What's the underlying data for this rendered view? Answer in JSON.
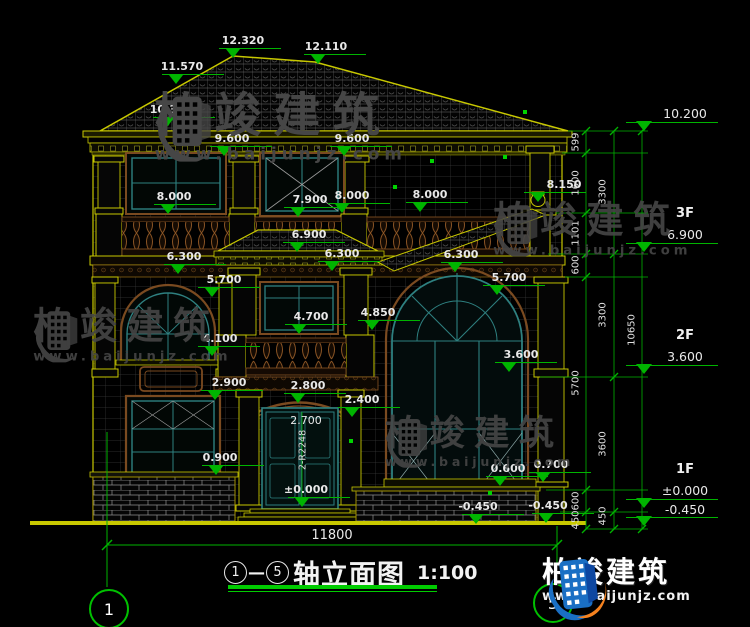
{
  "colors": {
    "bg": "#000000",
    "cad_yellow": "#c8c800",
    "cad_green": "#00b400",
    "text": "#e8e8e8",
    "window_teal": "#2e8080",
    "trim_brown": "#7a4a20",
    "logo_blue": "#1a6fc4",
    "logo_orange": "#f5821f"
  },
  "title_block": {
    "axis_from": "1",
    "axis_to": "5",
    "dash": "—",
    "title": "轴立面图",
    "scale": "1:100"
  },
  "axis_bubbles": {
    "left": "1",
    "right": "5"
  },
  "bottom_dim": "11800",
  "door_annotation": {
    "height": "2.700",
    "radius": "2-R2248"
  },
  "watermark": {
    "brand": "柏竣建筑",
    "url": "www.baijunjz.com"
  },
  "brand_logo": {
    "brand": "柏竣建筑",
    "url": "www.baijunjz.com"
  },
  "drawing": {
    "elevation_markers": [
      {
        "v": "12.320",
        "x": 233,
        "y": 58,
        "dx": 10
      },
      {
        "v": "12.110",
        "x": 318,
        "y": 64,
        "dx": 8
      },
      {
        "v": "11.570",
        "x": 176,
        "y": 84,
        "dx": 6
      },
      {
        "v": "10.350",
        "x": 167,
        "y": 127,
        "dx": 4
      },
      {
        "v": "9.600",
        "x": 224,
        "y": 156,
        "dx": 8
      },
      {
        "v": "9.600",
        "x": 344,
        "y": 156,
        "dx": 8
      },
      {
        "v": "8.000",
        "x": 168,
        "y": 214,
        "dx": 6
      },
      {
        "v": "7.900",
        "x": 298,
        "y": 217,
        "dx": 12
      },
      {
        "v": "8.000",
        "x": 342,
        "y": 213,
        "dx": 10
      },
      {
        "v": "8.000",
        "x": 420,
        "y": 212,
        "dx": 10
      },
      {
        "v": "8.150",
        "x": 538,
        "y": 202,
        "dx": 26
      },
      {
        "v": "6.900",
        "x": 297,
        "y": 252,
        "dx": 12
      },
      {
        "v": "6.300",
        "x": 178,
        "y": 274,
        "dx": 6
      },
      {
        "v": "6.300",
        "x": 332,
        "y": 271,
        "dx": 10
      },
      {
        "v": "6.300",
        "x": 455,
        "y": 272,
        "dx": 6
      },
      {
        "v": "5.700",
        "x": 212,
        "y": 297,
        "dx": 12
      },
      {
        "v": "5.700",
        "x": 497,
        "y": 295,
        "dx": 12
      },
      {
        "v": "4.850",
        "x": 372,
        "y": 330,
        "dx": 6
      },
      {
        "v": "4.700",
        "x": 299,
        "y": 334,
        "dx": 12
      },
      {
        "v": "4.100",
        "x": 212,
        "y": 356,
        "dx": 8
      },
      {
        "v": "3.600",
        "x": 509,
        "y": 372,
        "dx": 12
      },
      {
        "v": "2.900",
        "x": 215,
        "y": 400,
        "dx": 14
      },
      {
        "v": "2.800",
        "x": 298,
        "y": 403,
        "dx": 10
      },
      {
        "v": "2.400",
        "x": 352,
        "y": 417,
        "dx": 10
      },
      {
        "v": "0.900",
        "x": 216,
        "y": 475,
        "dx": 4
      },
      {
        "v": "0.600",
        "x": 500,
        "y": 486,
        "dx": 8
      },
      {
        "v": "0.700",
        "x": 543,
        "y": 482,
        "dx": 8
      },
      {
        "v": "±0.000",
        "x": 302,
        "y": 507,
        "dx": 4
      },
      {
        "v": "-0.450",
        "x": 476,
        "y": 524,
        "dx": 2
      },
      {
        "v": "-0.450",
        "x": 546,
        "y": 523,
        "dx": 2
      }
    ],
    "floor_markers": [
      {
        "label": "",
        "value": "10.200",
        "y": 131
      },
      {
        "label": "3F",
        "value": "6.900",
        "y": 252
      },
      {
        "label": "2F",
        "value": "3.600",
        "y": 374
      },
      {
        "label": "1F",
        "value": "±0.000",
        "value2": "-0.450",
        "y": 508
      }
    ],
    "dim_chains": {
      "inner": {
        "x": 576,
        "labels": [
          {
            "v": "599",
            "y": 142
          },
          {
            "v": "1600",
            "y": 183
          },
          {
            "v": "1101",
            "y": 233
          },
          {
            "v": "600",
            "y": 265
          },
          {
            "v": "5700",
            "y": 383
          },
          {
            "v": "600",
            "y": 501
          },
          {
            "v": "450",
            "y": 520
          }
        ]
      },
      "outer": {
        "x": 603,
        "labels": [
          {
            "v": "3300",
            "y": 192
          },
          {
            "v": "3300",
            "y": 315
          },
          {
            "v": "3600",
            "y": 444
          },
          {
            "v": "450",
            "y": 516
          }
        ]
      },
      "total": {
        "x": 632,
        "labels": [
          {
            "v": "10650",
            "y": 330
          }
        ]
      }
    },
    "watermark_instances": [
      {
        "x": 148,
        "y": 90,
        "s": 1.12,
        "o": 1
      },
      {
        "x": 28,
        "y": 306,
        "s": 0.88,
        "o": 0.9
      },
      {
        "x": 488,
        "y": 200,
        "s": 0.88,
        "o": 0.9
      },
      {
        "x": 380,
        "y": 414,
        "s": 0.84,
        "o": 0.9
      }
    ]
  }
}
